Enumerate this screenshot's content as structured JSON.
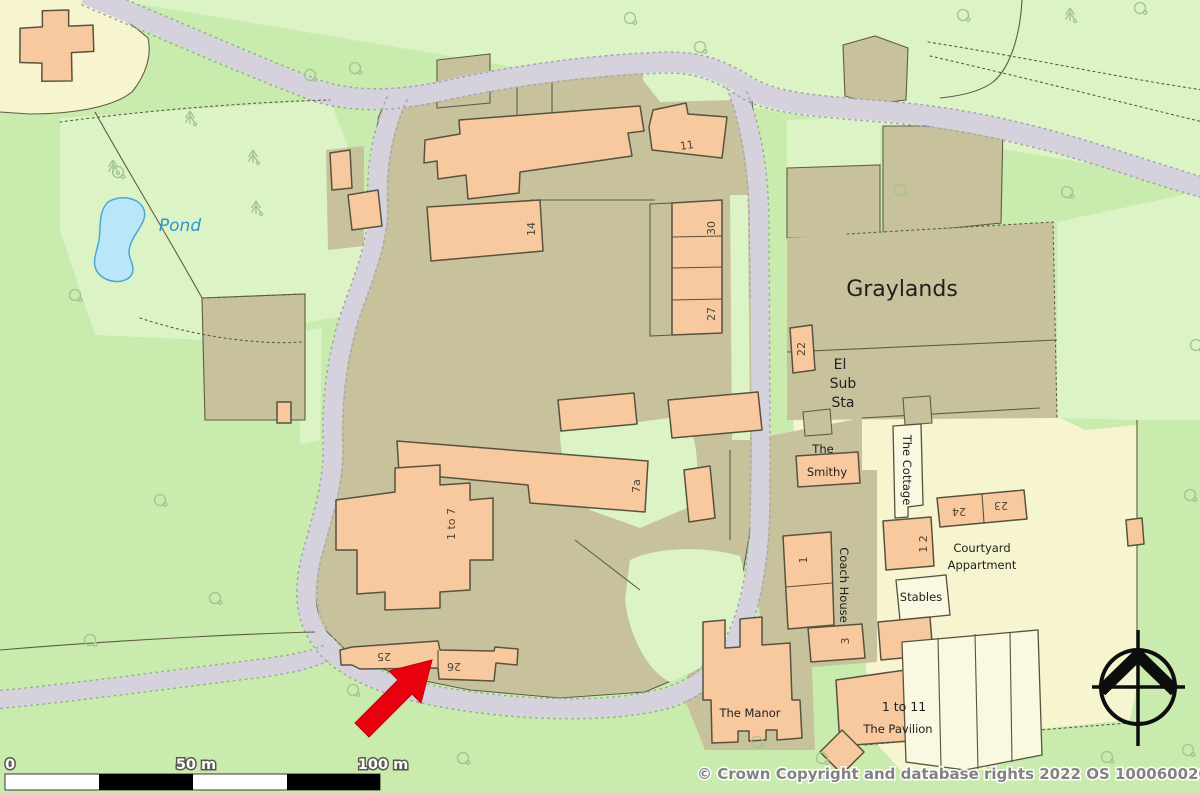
{
  "colors": {
    "green-light": "#dbf3c5",
    "green-mid": "#c9ebad",
    "khaki": "#c7c29c",
    "cream": "#f7f4d0",
    "pale-bldg": "#fbf8e1",
    "building": "#f8c99e",
    "road": "#d5d2de",
    "road-dot": "#a8a5b4",
    "line": "#5f5c45",
    "bstroke": "#56533e",
    "pond": "#b9e7f7",
    "pond-stroke": "#49a8d8",
    "pond-text": "#2d96d0",
    "text": "#1f1f1f",
    "num": "#4a4637",
    "tree": "#a3c48c",
    "red": "#e8000e"
  },
  "labels": {
    "pond": "Pond",
    "graylands": "Graylands",
    "el": "El",
    "sub": "Sub",
    "sta": "Sta",
    "the": "The",
    "smithy": "Smithy",
    "the_cottage": "The Cottage",
    "coach_house": "Coach House",
    "courtyard": "Courtyard",
    "appartment": "Appartment",
    "stables": "Stables",
    "the_manor": "The Manor",
    "one_to_eleven": "1 to 11",
    "the_pavilion": "The Pavilion"
  },
  "numbers": {
    "n11": "11",
    "n14": "14",
    "n30": "30",
    "n27": "27",
    "n22": "22",
    "n7a": "7a",
    "n1to7": "1 to 7",
    "n25": "25",
    "n26": "26",
    "n23": "23",
    "n24": "24",
    "n12": "1 2",
    "n1": "1",
    "n3": "3"
  },
  "scale_bar": {
    "zero": "0",
    "fifty": "50 m",
    "hundred": "100 m"
  },
  "footer": {
    "copyright": "© Crown Copyright and database rights 2022 OS 100060020"
  }
}
